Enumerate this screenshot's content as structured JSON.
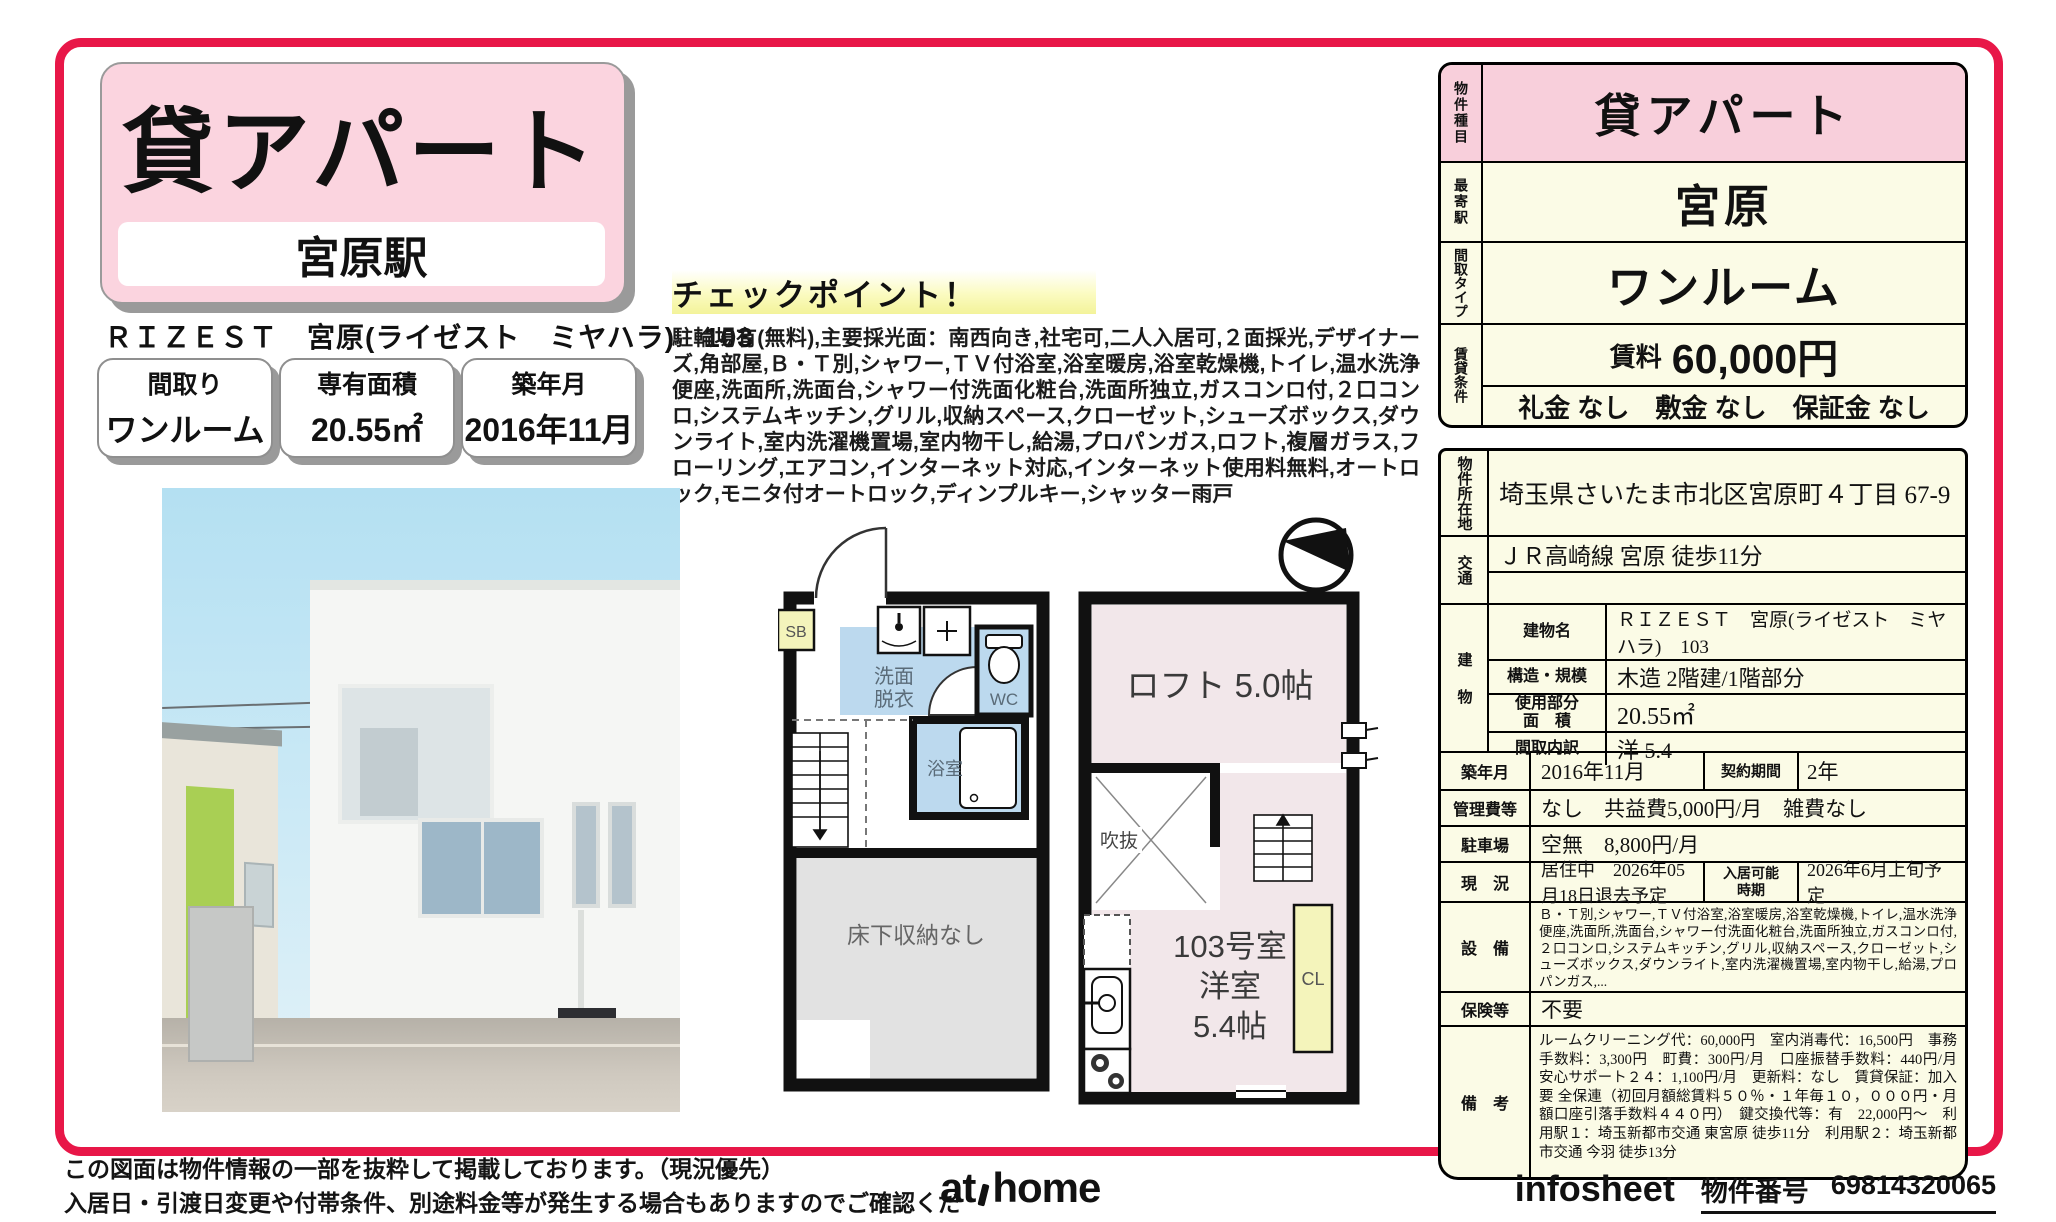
{
  "header": {
    "property_type": "貸アパート",
    "station": "宮原駅",
    "building_line": "ＲＩＺＥＳＴ　宮原(ライゼスト　ミヤハラ)　103",
    "chips": [
      {
        "label": "間取り",
        "value": "ワンルーム"
      },
      {
        "label": "専有面積",
        "value": "20.55㎡"
      },
      {
        "label": "築年月",
        "value": "2016年11月"
      }
    ]
  },
  "checkpoint": {
    "title": "チェックポイント！",
    "text": "駐輪場有(無料),主要採光面：南西向き,社宅可,二人入居可,２面採光,デザイナーズ,角部屋,Ｂ・Ｔ別,シャワー,ＴＶ付浴室,浴室暖房,浴室乾燥機,トイレ,温水洗浄便座,洗面所,洗面台,シャワー付洗面化粧台,洗面所独立,ガスコンロ付,２口コンロ,システムキッチン,グリル,収納スペース,クローゼット,シューズボックス,ダウンライト,室内洗濯機置場,室内物干し,給湯,プロパンガス,ロフト,複層ガラス,フローリング,エアコン,インターネット対応,インターネット使用料無料,オートロック,モニタ付オートロック,ディンプルキー,シャッター雨戸"
  },
  "summary_table": {
    "type_label": "物件種目",
    "type_value": "貸アパート",
    "station_label": "最寄駅",
    "station_value": "宮原",
    "layout_label": "間取タイプ",
    "layout_value": "ワンルーム",
    "terms_label": "賃貸条件",
    "rent_label": "賃料",
    "rent_value": "60,000円",
    "deposits": "礼金 なし　敷金 なし　保証金 なし"
  },
  "detail_table": {
    "location_label": "物件所在地",
    "location": "埼玉県さいたま市北区宮原町４丁目 67-9",
    "access_label": "交通",
    "access": "ＪＲ高崎線 宮原 徒歩11分",
    "building_label": "建物",
    "building_rows": [
      {
        "label": "建物名",
        "value": "ＲＩＺＥＳＴ　宮原(ライゼスト　ミヤハラ)　103"
      },
      {
        "label": "構造・規模",
        "value": "木造 2階建/1階部分"
      },
      {
        "label2a": "使用部分",
        "label2b": "面　積",
        "value": "20.55㎡"
      },
      {
        "label": "間取内訳",
        "value": "洋 5.4"
      }
    ],
    "built_label": "築年月",
    "built_value": "2016年11月",
    "contract_label": "契約期間",
    "contract_value": "2年",
    "fees_label": "管理費等",
    "fees_value": "なし　共益費5,000円/月　雑費なし",
    "parking_label": "駐車場",
    "parking_value": "空無　8,800円/月",
    "status_label": "現　況",
    "status_value": "居住中　2026年05月18日退去予定",
    "movein_label_1": "入居可能",
    "movein_label_2": "時期",
    "movein_value": "2026年6月上旬予定",
    "equipment_label": "設　備",
    "equipment_value": "Ｂ・Ｔ別,シャワー,ＴＶ付浴室,浴室暖房,浴室乾燥機,トイレ,温水洗浄便座,洗面所,洗面台,シャワー付洗面化粧台,洗面所独立,ガスコンロ付,２口コンロ,システムキッチン,グリル,収納スペース,クローゼット,シューズボックス,ダウンライト,室内洗濯機置場,室内物干し,給湯,プロパンガス,...",
    "insurance_label": "保険等",
    "insurance_value": "不要",
    "remarks_label": "備　考",
    "remarks_value": "ルームクリーニング代：60,000円　室内消毒代：16,500円　事務手数料：3,300円　町費：300円/月　口座振替手数料：440円/月　安心サポート２４：1,100円/月　更新料：なし　賃貸保証：加入要 全保連（初回月額総賃料５０％・１年毎１０，０００円・月額口座引落手数料４４０円）　鍵交換代等：有　22,000円～　利用駅１：埼玉新都市交通 東宮原 徒歩11分　利用駅２：埼玉新都市交通 今羽 徒歩13分"
  },
  "floorplan": {
    "sb": "SB",
    "washroom_1": "洗面",
    "washroom_2": "脱衣",
    "wc": "WC",
    "bath": "浴室",
    "underfloor": "床下収納なし",
    "loft": "ロフト 5.0帖",
    "void": "吹抜",
    "room_1": "103号室",
    "room_2": "洋室",
    "room_3": "5.4帖",
    "closet": "CL"
  },
  "footer": {
    "note_line1": "この図面は物件情報の一部を抜粋して掲載しております。（現況優先）",
    "note_line2": "入居日・引渡日変更や付帯条件、別途料金等が発生する場合もありますのでご確認ください。",
    "logo_left": "at",
    "logo_right": "home",
    "sheet_name": "infosheet",
    "property_number_label": "物件番号",
    "property_number": "69814320065"
  },
  "colors": {
    "border": "#e81748",
    "pink": "#f8cfdb",
    "cream": "#fbfbe6"
  }
}
